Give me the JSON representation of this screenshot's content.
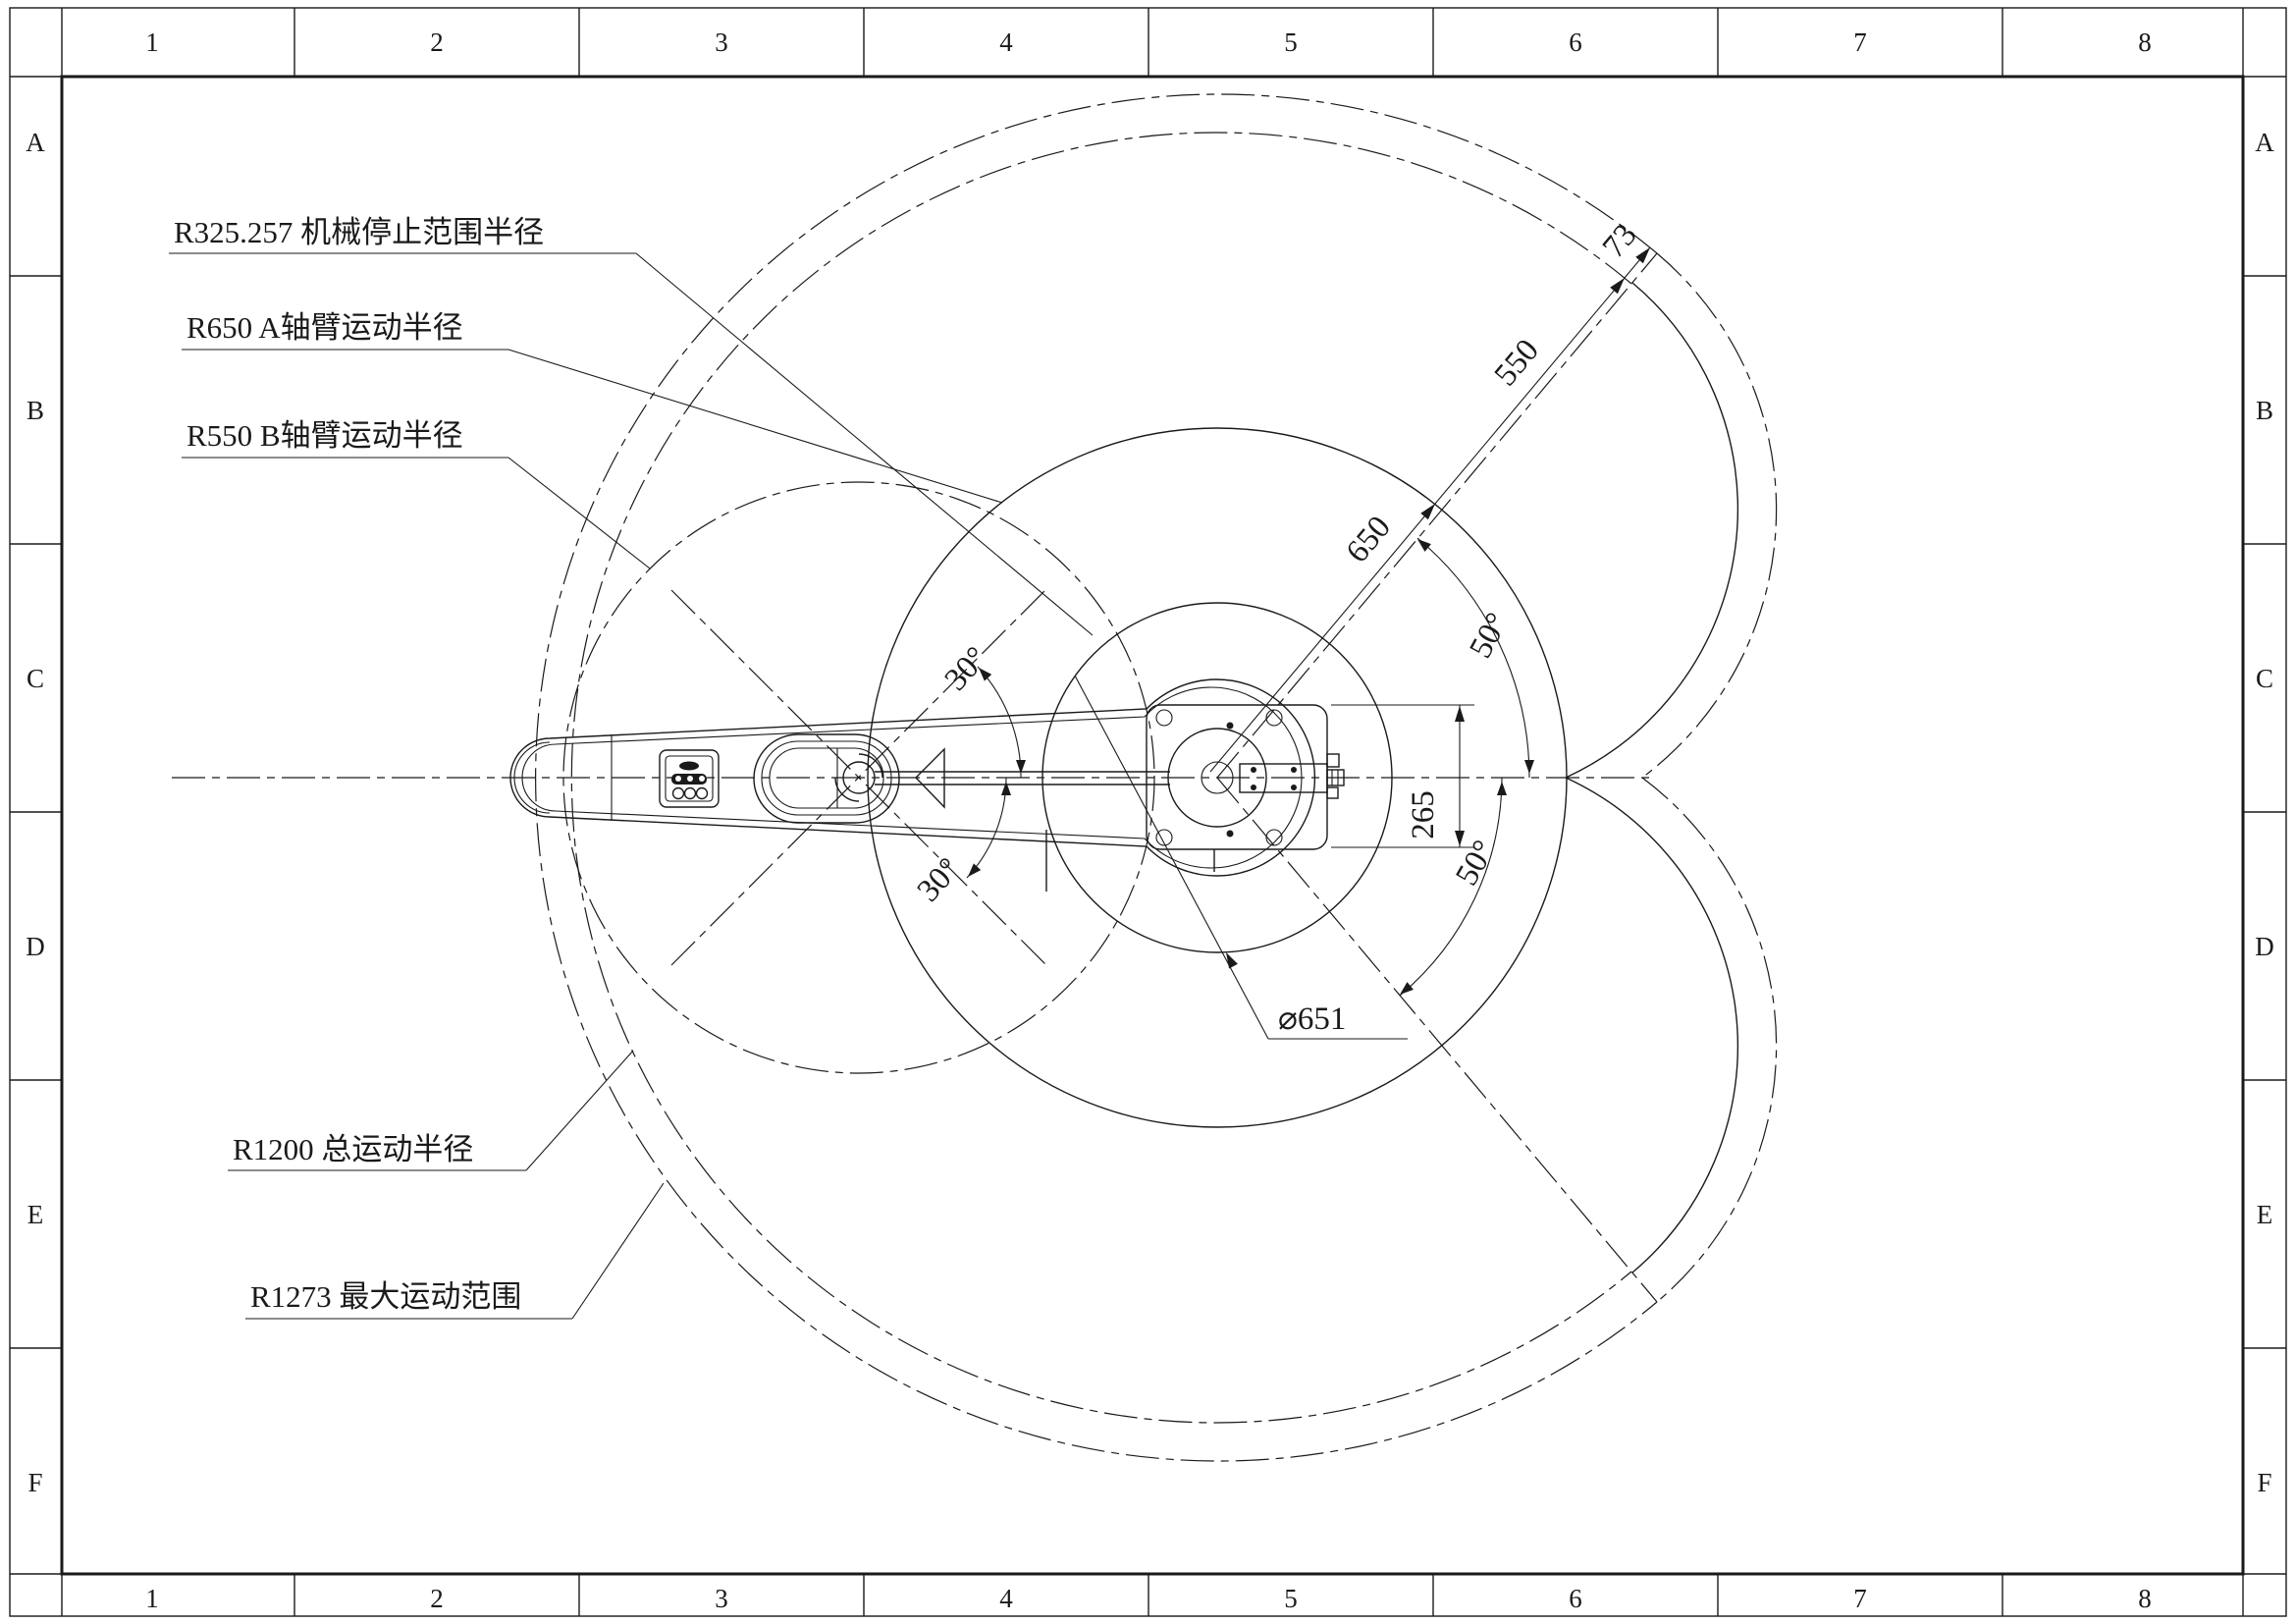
{
  "frame": {
    "cols": [
      "1",
      "2",
      "3",
      "4",
      "5",
      "6",
      "7",
      "8"
    ],
    "rows": [
      "A",
      "B",
      "C",
      "D",
      "E",
      "F"
    ]
  },
  "labels": {
    "stop_radius": "R325.257 机械停止范围半径",
    "a_arm_radius": "R650 A轴臂运动半径",
    "b_arm_radius": "R550 B轴臂运动半径",
    "total_radius": "R1200 总运动半径",
    "max_range": "R1273 最大运动范围",
    "base_diameter": "⌀651"
  },
  "dims": {
    "seg_650": "650",
    "seg_550": "550",
    "seg_73": "73",
    "base_width": "265",
    "angle_upper_50": "50°",
    "angle_lower_50": "50°",
    "angle_upper_30": "30°",
    "angle_lower_30": "30°"
  },
  "colors": {
    "line": "#1a1a1a",
    "paper": "#ffffff"
  }
}
